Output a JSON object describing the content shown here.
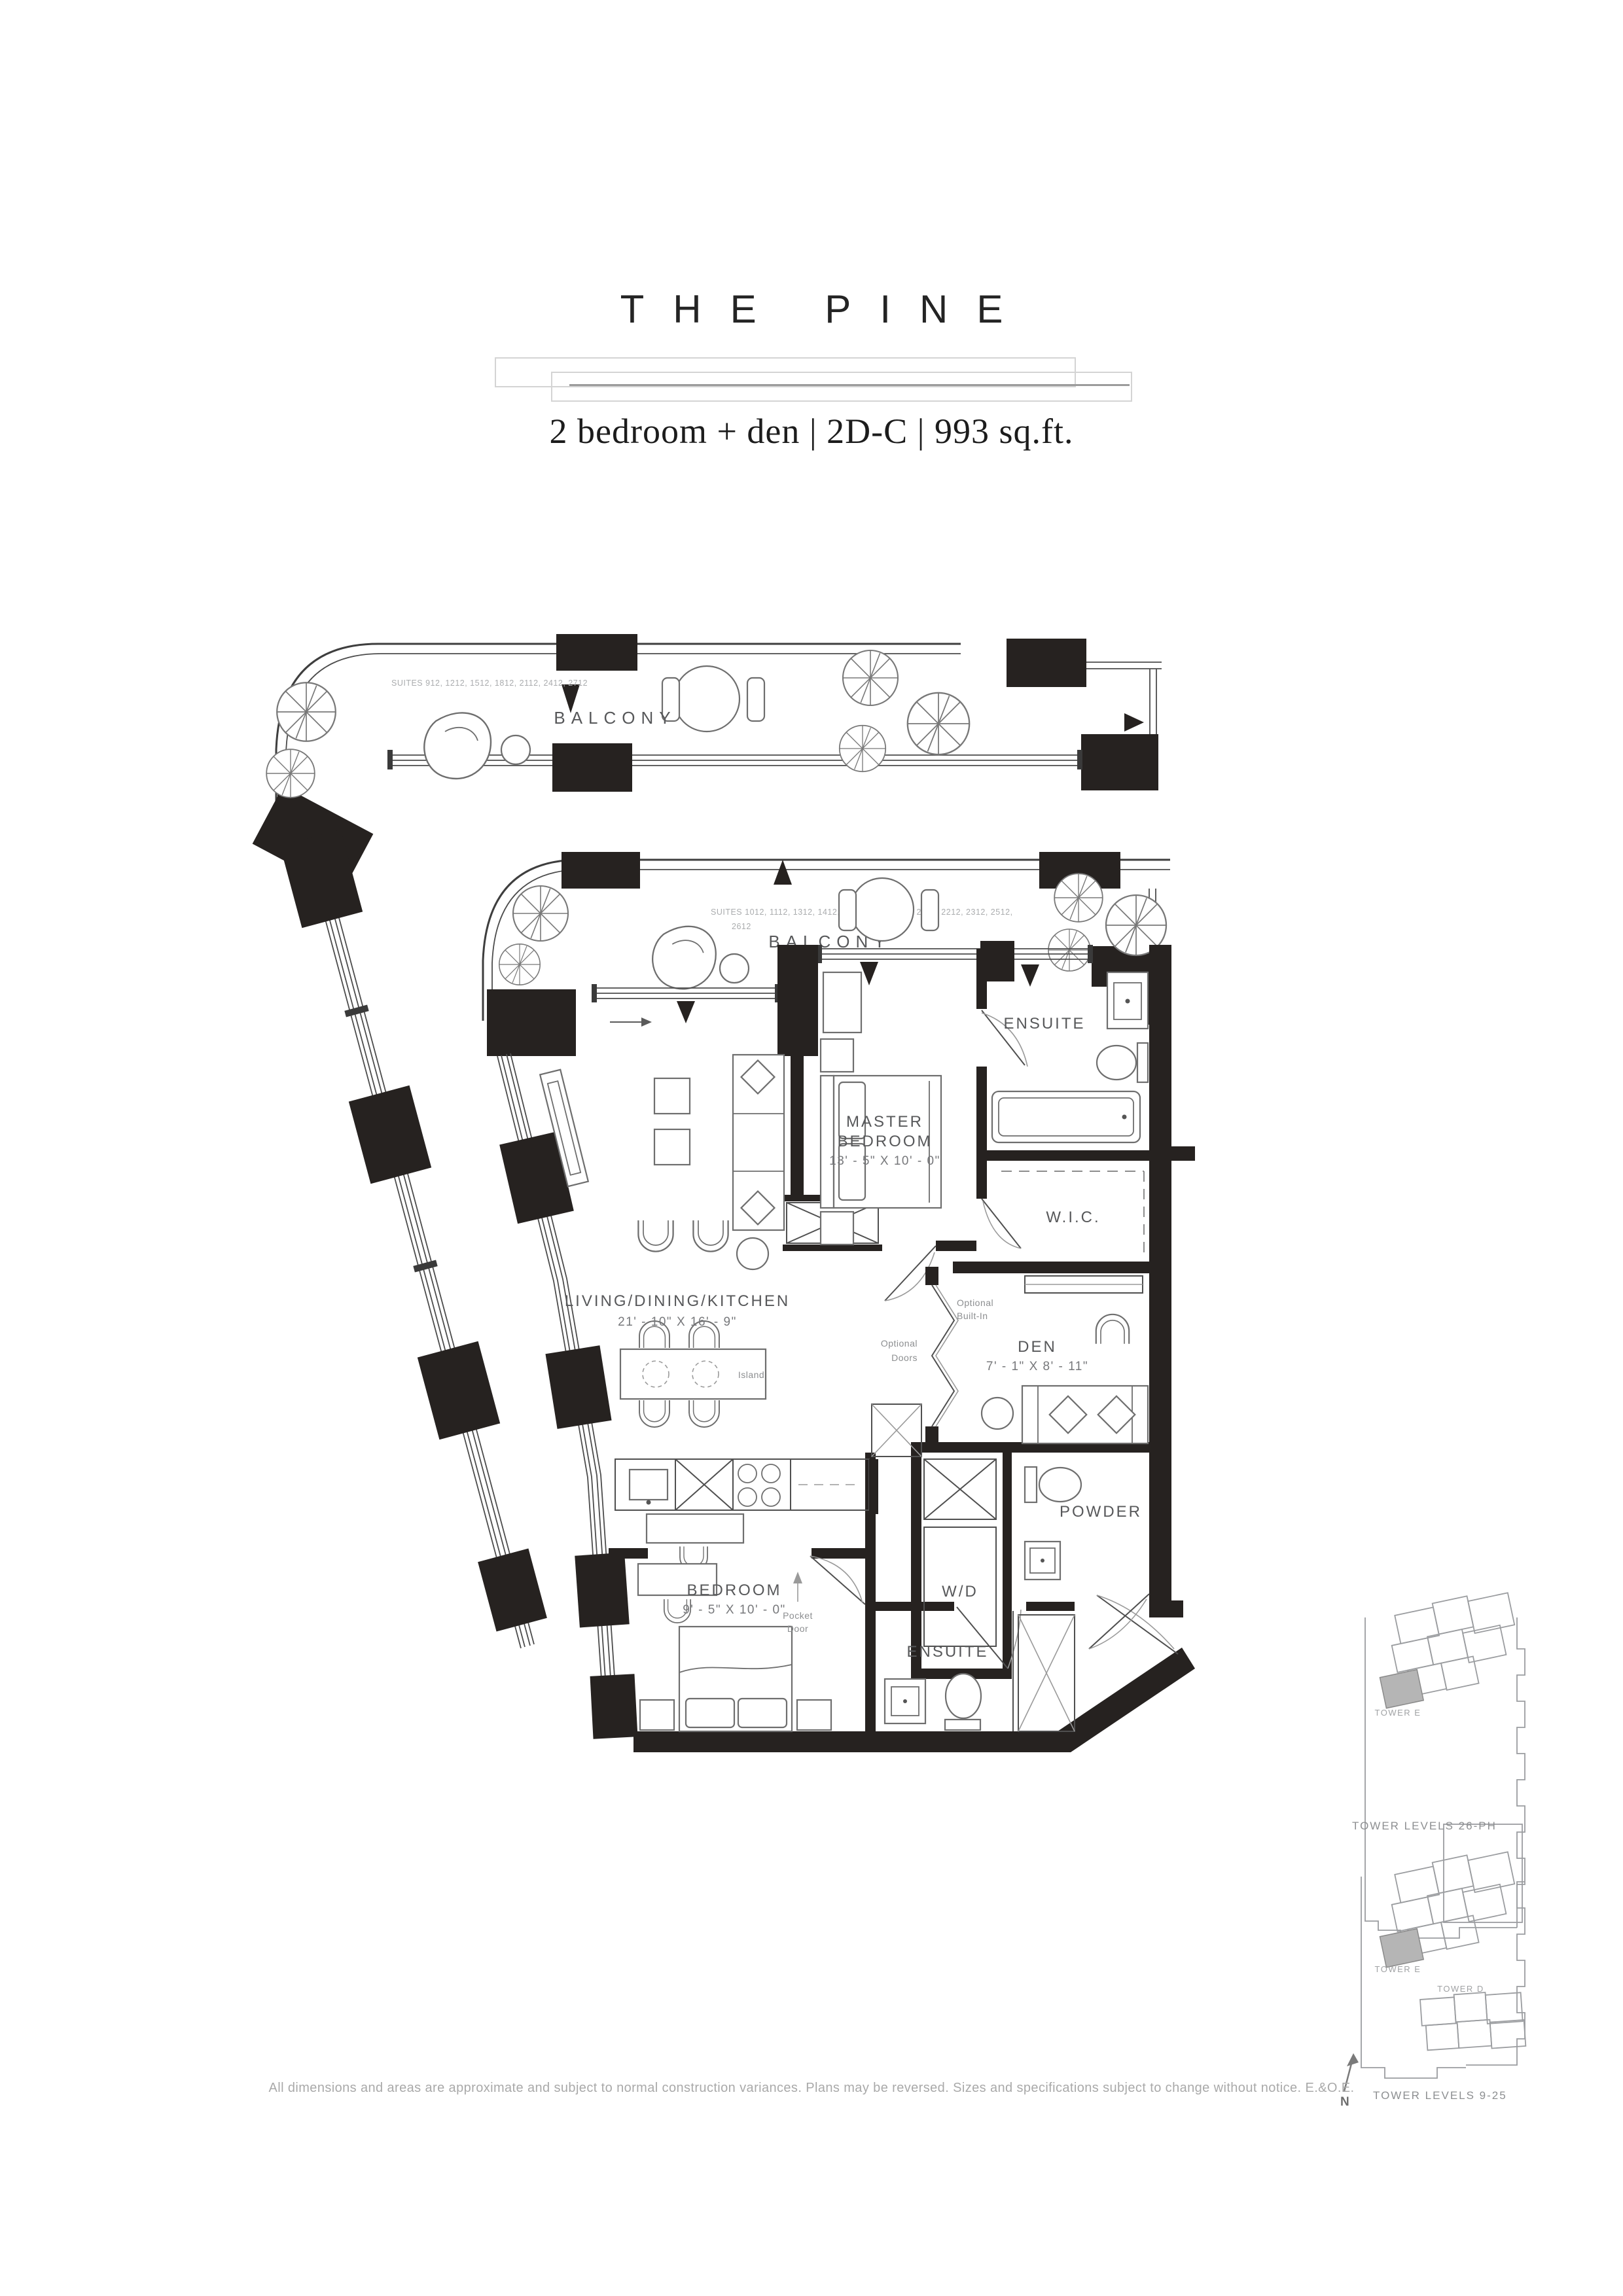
{
  "header": {
    "title": "THE PINE",
    "subtitle": "2 bedroom + den | 2D-C | 993 sq.ft."
  },
  "plan": {
    "balcony_upper": {
      "label": "BALCONY",
      "suites": "SUITES 912, 1212, 1512, 1812, 2112, 2412, 2712"
    },
    "balcony_main": {
      "label": "BALCONY",
      "suites_line1": "SUITES 1012, 1112, 1312, 1412, 1612, 1712, 1912, 2012, 2212, 2312, 2512,",
      "suites_line2": "2612"
    },
    "rooms": {
      "master": {
        "line1": "MASTER",
        "line2": "BEDROOM",
        "dims": "13' - 5\" X 10' - 0\""
      },
      "ensuite_top": {
        "name": "ENSUITE"
      },
      "wic": {
        "name": "W.I.C."
      },
      "den": {
        "name": "DEN",
        "dims": "7' - 1\" X 8' - 11\""
      },
      "living": {
        "name": "LIVING/DINING/KITCHEN",
        "dims": "21' - 10\" X 16' - 9\""
      },
      "wd": {
        "name": "W/D"
      },
      "powder": {
        "name": "POWDER"
      },
      "bedroom": {
        "name": "BEDROOM",
        "dims": "9' - 5\" X 10' - 0\""
      },
      "ensuite_bottom": {
        "name": "ENSUITE"
      }
    },
    "notes": {
      "optional_builtin_line1": "Optional",
      "optional_builtin_line2": "Built-In",
      "optional_doors_line1": "Optional",
      "optional_doors_line2": "Doors",
      "pocket_door_line1": "Pocket",
      "pocket_door_line2": "Door",
      "island": "Island"
    }
  },
  "keyplans": {
    "upper": {
      "tower_e": "TOWER E",
      "caption": "TOWER LEVELS 26-PH"
    },
    "lower": {
      "tower_e": "TOWER E",
      "tower_d": "TOWER D",
      "caption": "TOWER LEVELS 9-25",
      "north": "N"
    }
  },
  "footer": {
    "disclaimer": "All dimensions and areas are approximate and subject to normal construction variances. Plans may be reversed. Sizes and specifications subject to change without notice. E.&O.E."
  },
  "colors": {
    "ink": "#262220",
    "label_gray": "#57585a",
    "light_gray": "#aaacae",
    "highlight": "#b5b5b5"
  }
}
